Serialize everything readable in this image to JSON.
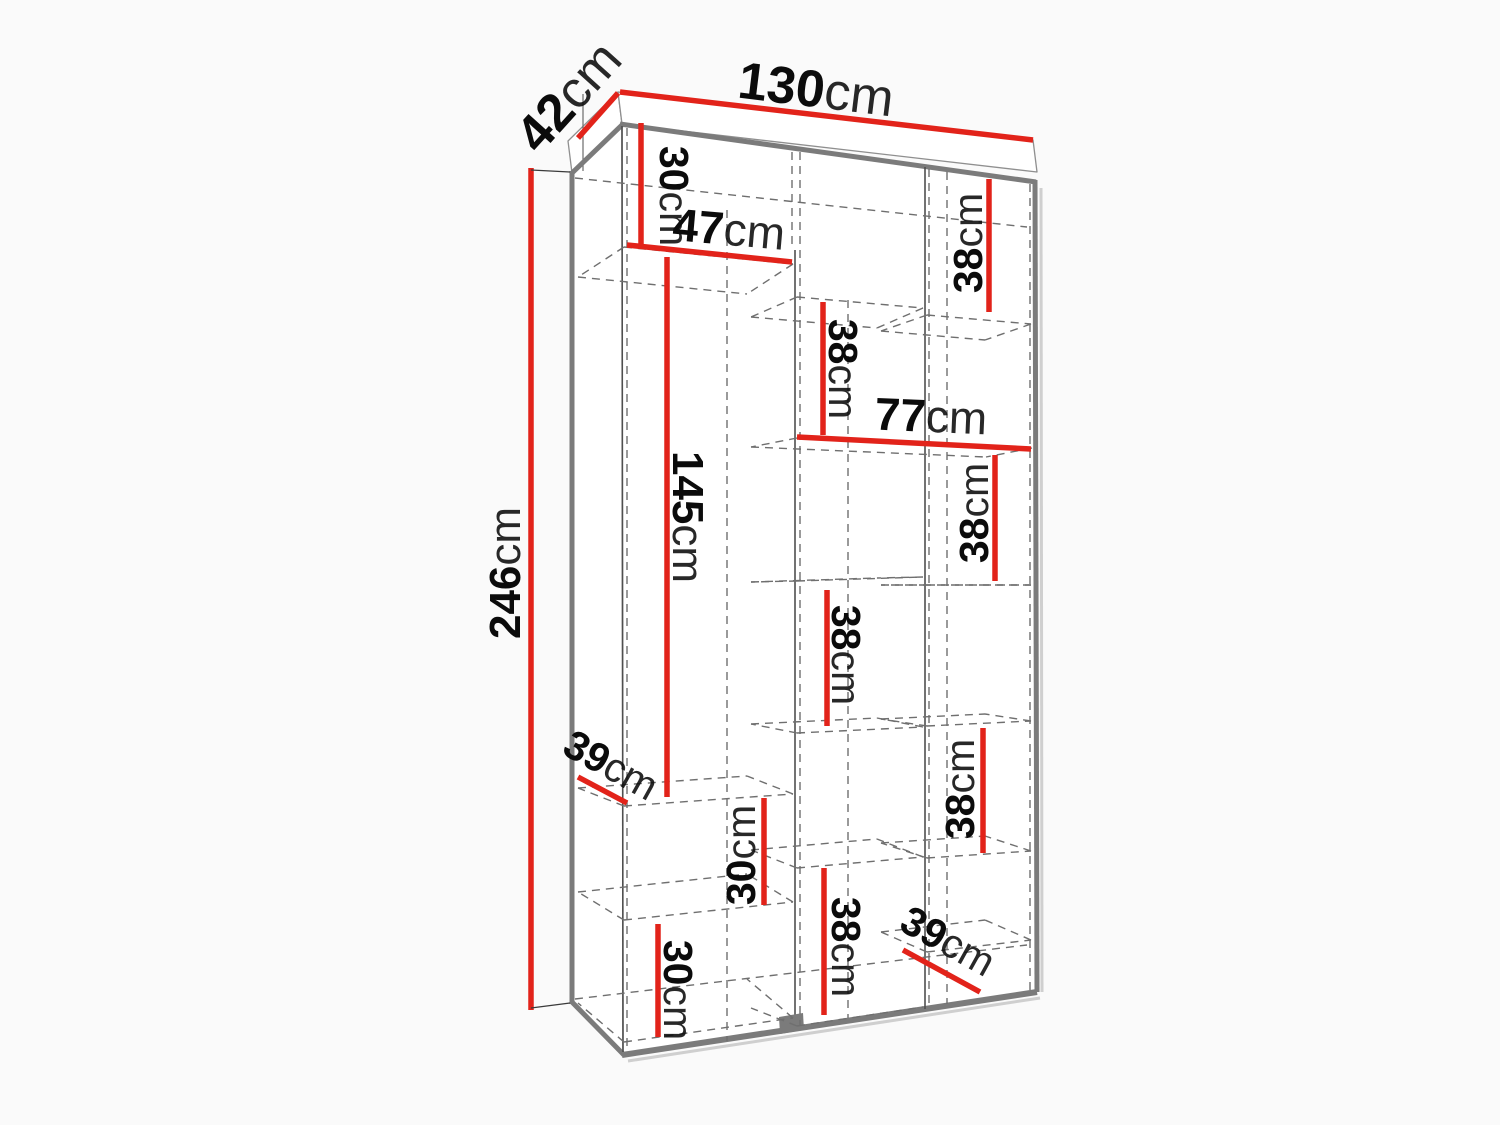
{
  "diagram": {
    "kind": "wardrobe-dimension-diagram",
    "unit": "cm",
    "colors": {
      "dimension_line": "#e2231a",
      "structure_gray": "#7b7b7b",
      "label_text": "#0b0b0b"
    },
    "dimensions": {
      "overall": {
        "width": {
          "num": "130",
          "unit": "cm"
        },
        "depth": {
          "num": "42",
          "unit": "cm"
        },
        "height": {
          "num": "246",
          "unit": "cm"
        }
      },
      "sections": {
        "s30a": {
          "num": "30",
          "unit": "cm"
        },
        "s47": {
          "num": "47",
          "unit": "cm"
        },
        "s145": {
          "num": "145",
          "unit": "cm"
        },
        "s38a": {
          "num": "38",
          "unit": "cm"
        },
        "s38b": {
          "num": "38",
          "unit": "cm"
        },
        "s77": {
          "num": "77",
          "unit": "cm"
        },
        "s38c": {
          "num": "38",
          "unit": "cm"
        },
        "s38d": {
          "num": "38",
          "unit": "cm"
        },
        "s38e": {
          "num": "38",
          "unit": "cm"
        },
        "s30b": {
          "num": "30",
          "unit": "cm"
        },
        "s39a": {
          "num": "39",
          "unit": "cm"
        },
        "s30c": {
          "num": "30",
          "unit": "cm"
        },
        "s38f": {
          "num": "38",
          "unit": "cm"
        },
        "s39b": {
          "num": "39",
          "unit": "cm"
        }
      }
    }
  }
}
